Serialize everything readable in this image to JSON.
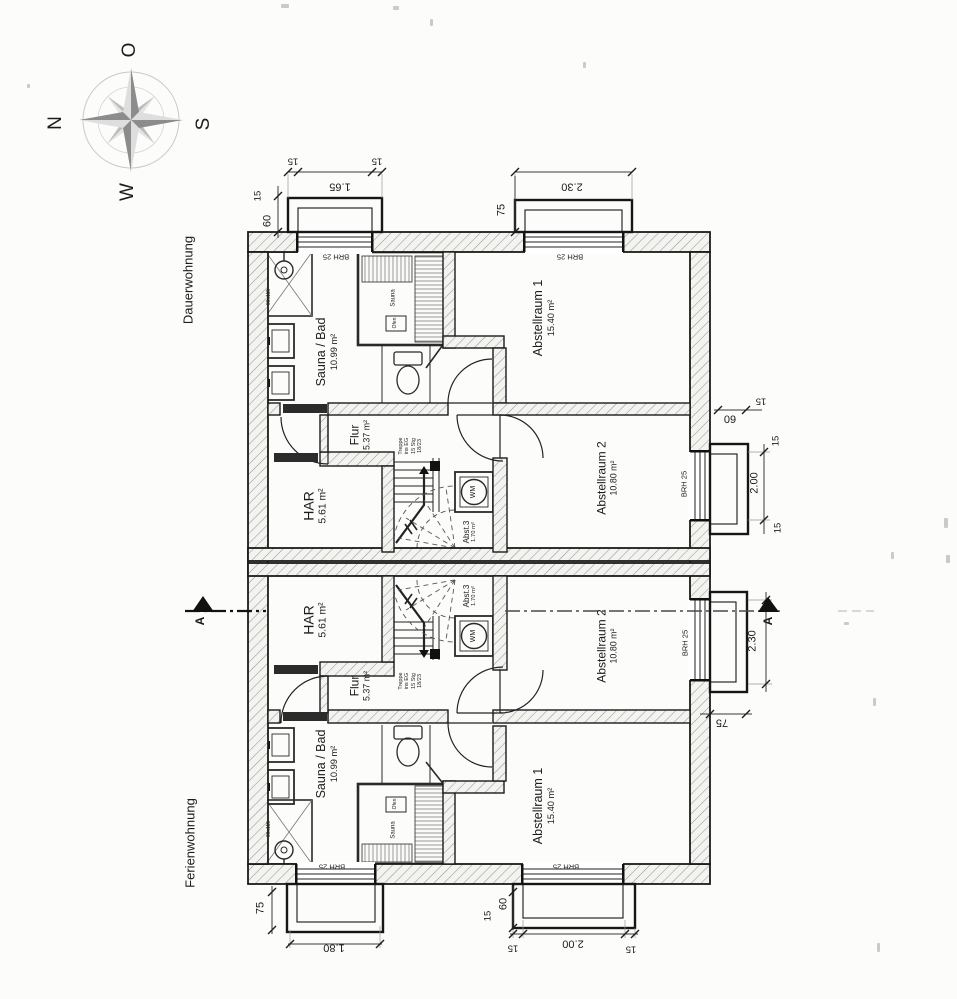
{
  "compass": {
    "north": "N",
    "east": "O",
    "south": "S",
    "west": "W"
  },
  "units": {
    "top": "Dauerwohnung",
    "bottom": "Ferienwohnung"
  },
  "rooms": {
    "sauna_bad": {
      "name": "Sauna / Bad",
      "area": "10.99 m²"
    },
    "flur": {
      "name": "Flur",
      "area": "5.37 m²"
    },
    "har": {
      "name": "HAR",
      "area": "5.61 m²"
    },
    "abstellraum1": {
      "name": "Abstellraum 1",
      "area": "15.40 m²"
    },
    "abstellraum2": {
      "name": "Abstellraum 2",
      "area": "10.80 m²"
    },
    "abst3": {
      "name": "Abst.3",
      "area": "1.70 m²"
    }
  },
  "stair_note": {
    "line1": "Treppe",
    "line2": "ins EG",
    "line3": "15 Stg",
    "line4": "18/23"
  },
  "fixtures": {
    "washing_machine": "WM",
    "sauna": "Sauna",
    "stove": "Ofen",
    "shower_size": "90x115"
  },
  "window_sill_label": "BRH 25",
  "dimensions": {
    "w165": "1.65",
    "w230": "2.30",
    "w200": "2.00",
    "w180": "1.80",
    "s15": "15",
    "s60": "60",
    "s75": "75"
  },
  "section_marker": "A"
}
